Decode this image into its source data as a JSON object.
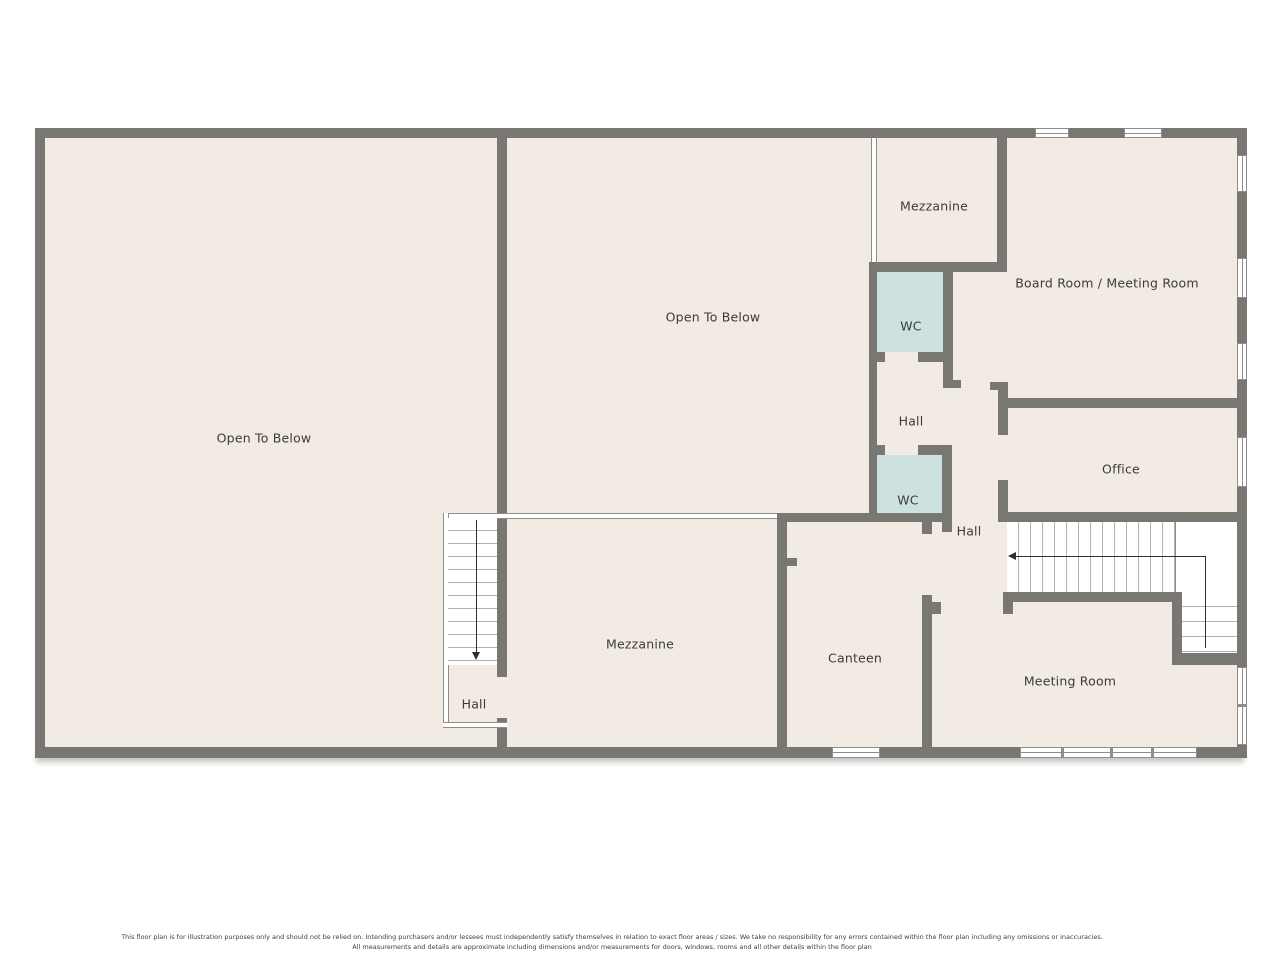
{
  "floorplan": {
    "title": "First floor / mezzanine level floor plan",
    "rooms": [
      {
        "id": "open-to-below-left",
        "label": "Open To Below"
      },
      {
        "id": "open-to-below-center",
        "label": "Open To Below"
      },
      {
        "id": "mezzanine-upper",
        "label": "Mezzanine"
      },
      {
        "id": "wc-upper",
        "label": "WC"
      },
      {
        "id": "board-room",
        "label": "Board Room / Meeting Room"
      },
      {
        "id": "hall-upper",
        "label": "Hall"
      },
      {
        "id": "wc-lower",
        "label": "WC"
      },
      {
        "id": "office",
        "label": "Office"
      },
      {
        "id": "hall-mid",
        "label": "Hall"
      },
      {
        "id": "mezzanine-lower",
        "label": "Mezzanine"
      },
      {
        "id": "canteen",
        "label": "Canteen"
      },
      {
        "id": "meeting-room",
        "label": "Meeting Room"
      },
      {
        "id": "hall-lower",
        "label": "Hall"
      }
    ],
    "features": [
      "staircase-upper-right",
      "staircase-lower-left",
      "windows",
      "railings"
    ],
    "colors": {
      "wall": "#797772",
      "floor": "#f2ebe3",
      "wc_fill": "#cde1e0",
      "detail_line": "#8f8d87",
      "text": "#3b3b3b",
      "background": "#ffffff"
    },
    "disclaimer": {
      "line1": "This floor plan is for illustration purposes only and should not be relied on. Intending purchasers and/or lessees must independently satisfy themselves in relation to exact floor areas / sizes. We take no responsibility for any errors contained within the floor plan including any omissions or inaccuracies.",
      "line2": "All measurements and details are approximate including dimensions and/or measurements for doors, windows, rooms and all other details within the floor plan"
    }
  }
}
